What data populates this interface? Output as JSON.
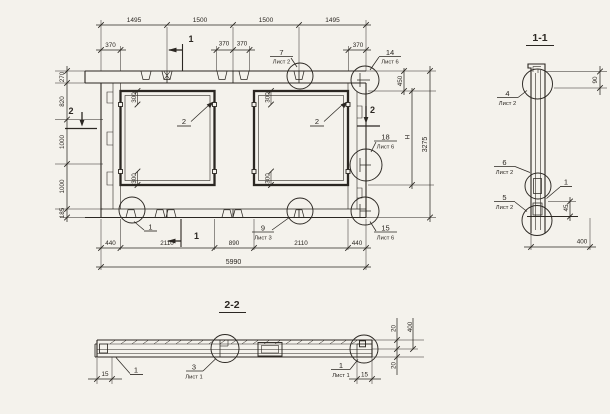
{
  "meta": {
    "paper_color": "#f4f2ec",
    "ink_color": "#2b2722"
  },
  "plan": {
    "dims_top": [
      "1495",
      "1500",
      "1500",
      "1495"
    ],
    "dims_offset": [
      "370",
      "370",
      "370",
      "370"
    ],
    "dims_left": [
      "270",
      "820",
      "1000",
      "1000",
      "185"
    ],
    "dims_bottom": [
      "440",
      "2110",
      "890",
      "2110",
      "440"
    ],
    "dim_overall_width": "5990",
    "dim_overall_height": "3275",
    "dim_top_right": "450",
    "dim_height_letter": "Н",
    "opening_dims": [
      "300",
      "300",
      "300",
      "300"
    ],
    "marker_section1_top": "1",
    "marker_section1_bottom": "1",
    "marker_section2_left": "2",
    "marker_section2_right": "2",
    "callout_opening_a": "2",
    "callout_opening_b": "2",
    "callout_bottom_left": "1",
    "callout_7": {
      "num": "7",
      "sheet": "Лист 2"
    },
    "callout_14": {
      "num": "14",
      "sheet": "Лист 6"
    },
    "callout_18": {
      "num": "18",
      "sheet": "Лист 6"
    },
    "callout_15": {
      "num": "15",
      "sheet": "Лист 6"
    },
    "callout_9": {
      "num": "9",
      "sheet": "Лист 3"
    }
  },
  "section_1_1": {
    "title": "1-1",
    "callout_4": {
      "num": "4",
      "sheet": "Лист 2"
    },
    "callout_6": {
      "num": "6",
      "sheet": "Лист 2"
    },
    "callout_5": {
      "num": "5",
      "sheet": "Лист 2"
    },
    "callout_1": "1",
    "dim_top": "90",
    "dim_step": "45",
    "dim_width": "400"
  },
  "section_2_2": {
    "title": "2-2",
    "callout_left": "1",
    "callout_3": {
      "num": "3",
      "sheet": "Лист 1"
    },
    "callout_right": {
      "num": "1",
      "sheet": "Лист 1"
    },
    "dim_lip_left": "15",
    "dim_lip_right": "15",
    "dim_20_top": "20",
    "dim_20_bottom": "20",
    "dim_400": "400"
  }
}
